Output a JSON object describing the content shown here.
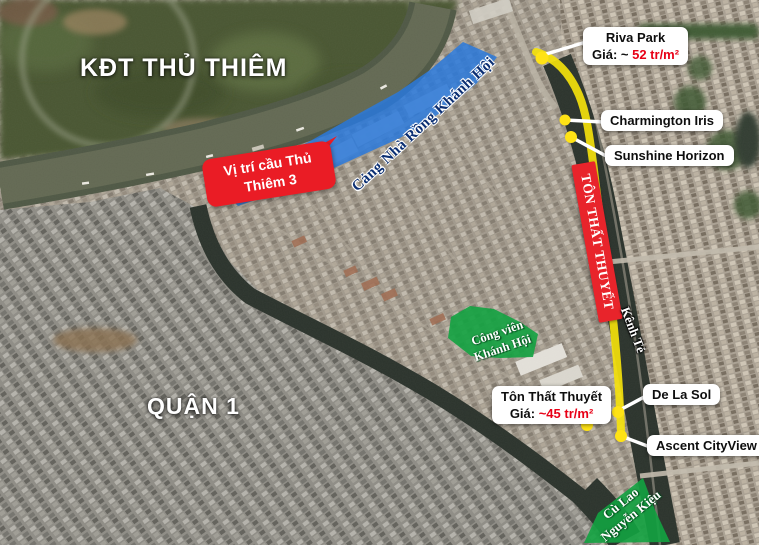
{
  "colors": {
    "road_yellow": "#f4e10c",
    "marker_yellow": "#ffe315",
    "annotation_red": "#e8242b",
    "zone_blue": "#2a79dc",
    "zone_green": "#13a341",
    "price_red": "#e80016",
    "port_text_navy": "#0b2f73"
  },
  "area_labels": {
    "thu_thiem": "KĐT THỦ THIÊM",
    "quan1": "QUẬN 1"
  },
  "bridge_callout": {
    "line1": "Vị trí cầu Thủ",
    "line2": "Thiêm 3"
  },
  "zones": {
    "port": "Cảng Nhà Rồng Khánh Hội",
    "park": {
      "line1": "Công viên",
      "line2": "Khánh Hội"
    },
    "islet": {
      "line1": "Cù Lao",
      "line2": "Nguyễn Kiệu"
    }
  },
  "road_banner": "TÔN THẤT THUYẾT",
  "waterway": "Kênh Tẻ",
  "projects": {
    "riva": {
      "name": "Riva Park",
      "price_label": "Giá: ~ ",
      "price": "52 tr/m²"
    },
    "charmington": {
      "name": "Charmington Iris"
    },
    "sunshine": {
      "name": "Sunshine Horizon"
    },
    "delasol": {
      "name": "De La Sol"
    },
    "ascent": {
      "name": "Ascent CityView"
    },
    "tonthatthuyet": {
      "name": "Tôn Thất Thuyết",
      "price_label": "Giá: ",
      "price": "~45 tr/m²"
    }
  }
}
